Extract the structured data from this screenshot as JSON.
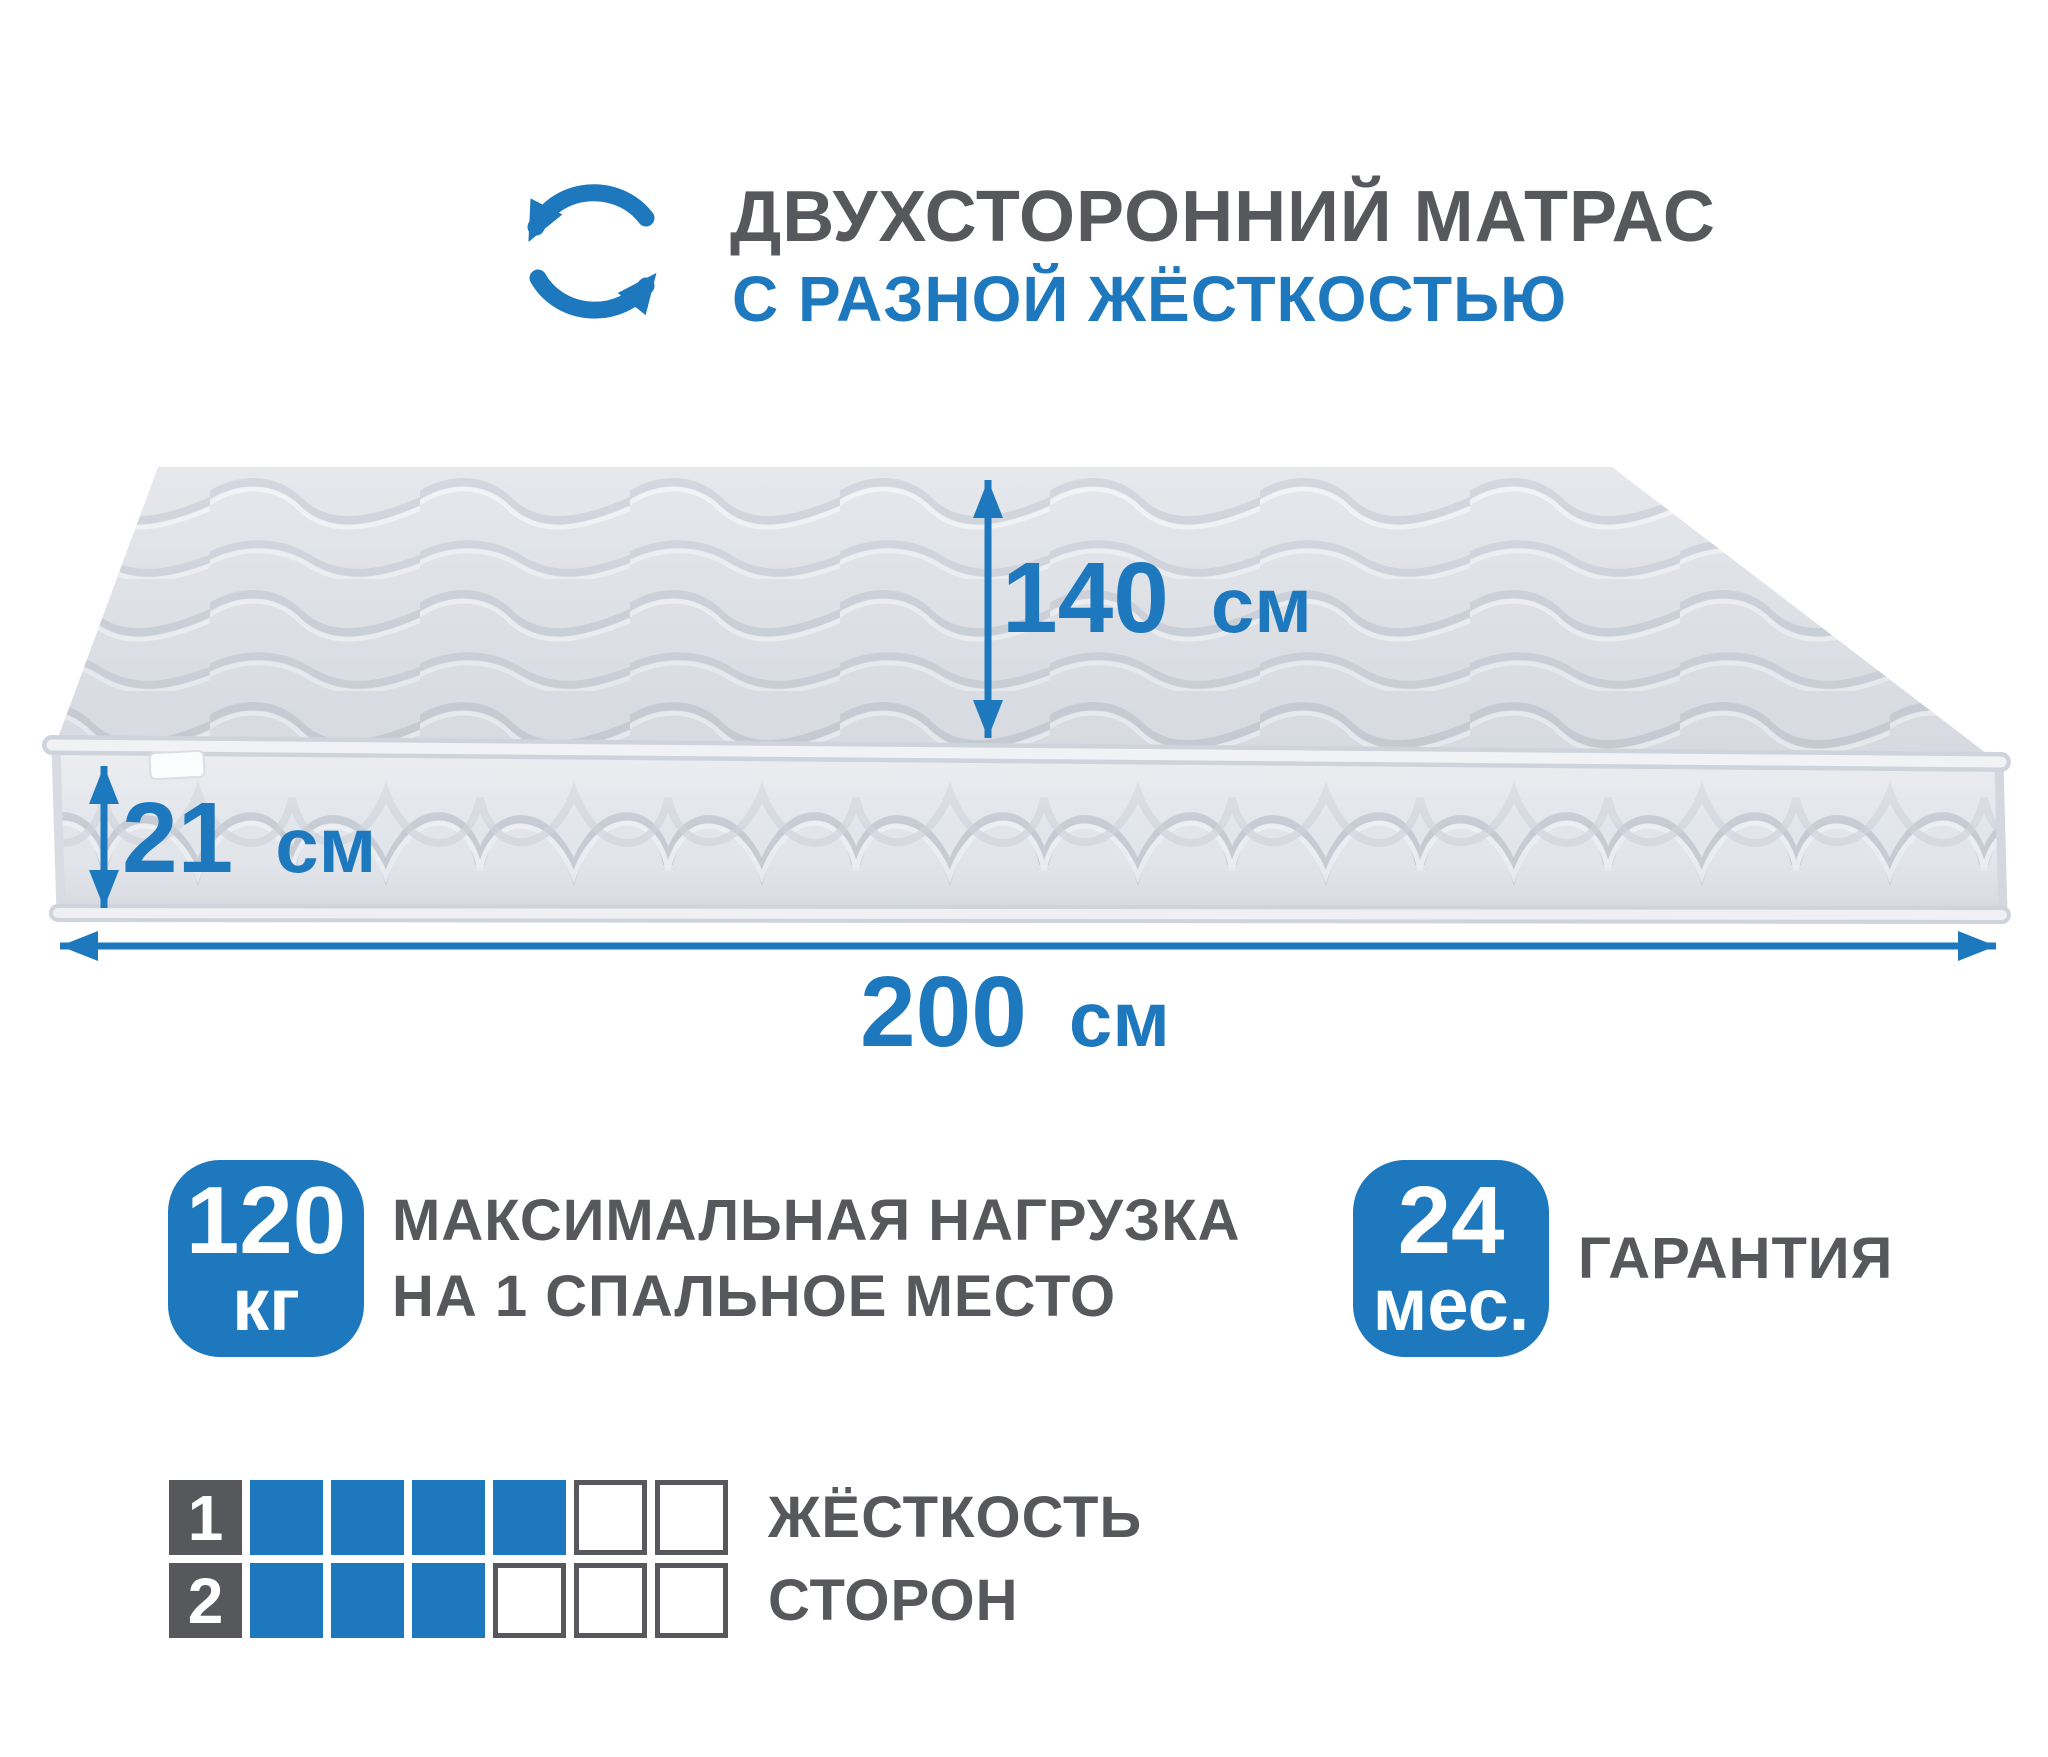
{
  "header": {
    "icon": "rotate-arrows-icon",
    "title": "ДВУХСТОРОННИЙ МАТРАС",
    "subtitle": "С РАЗНОЙ ЖЁСТКОСТЬЮ"
  },
  "dimensions": {
    "width": {
      "value": "140",
      "unit": "см"
    },
    "thickness": {
      "value": "21",
      "unit": "см"
    },
    "length": {
      "value": "200",
      "unit": "см"
    }
  },
  "max_load": {
    "value": "120",
    "unit": "кг",
    "label_line1": "МАКСИМАЛЬНАЯ НАГРУЗКА",
    "label_line2": "НА 1 СПАЛЬНОЕ МЕСТО"
  },
  "warranty": {
    "value": "24",
    "unit": "мес.",
    "label": "ГАРАНТИЯ"
  },
  "firmness": {
    "label_line1": "ЖЁСТКОСТЬ",
    "label_line2": "СТОРОН",
    "scale_max": 6,
    "sides": [
      {
        "side": "1",
        "filled": 4
      },
      {
        "side": "2",
        "filled": 3
      }
    ]
  },
  "colors": {
    "accent_blue": "#1e78be",
    "text_gray": "#57585b"
  }
}
